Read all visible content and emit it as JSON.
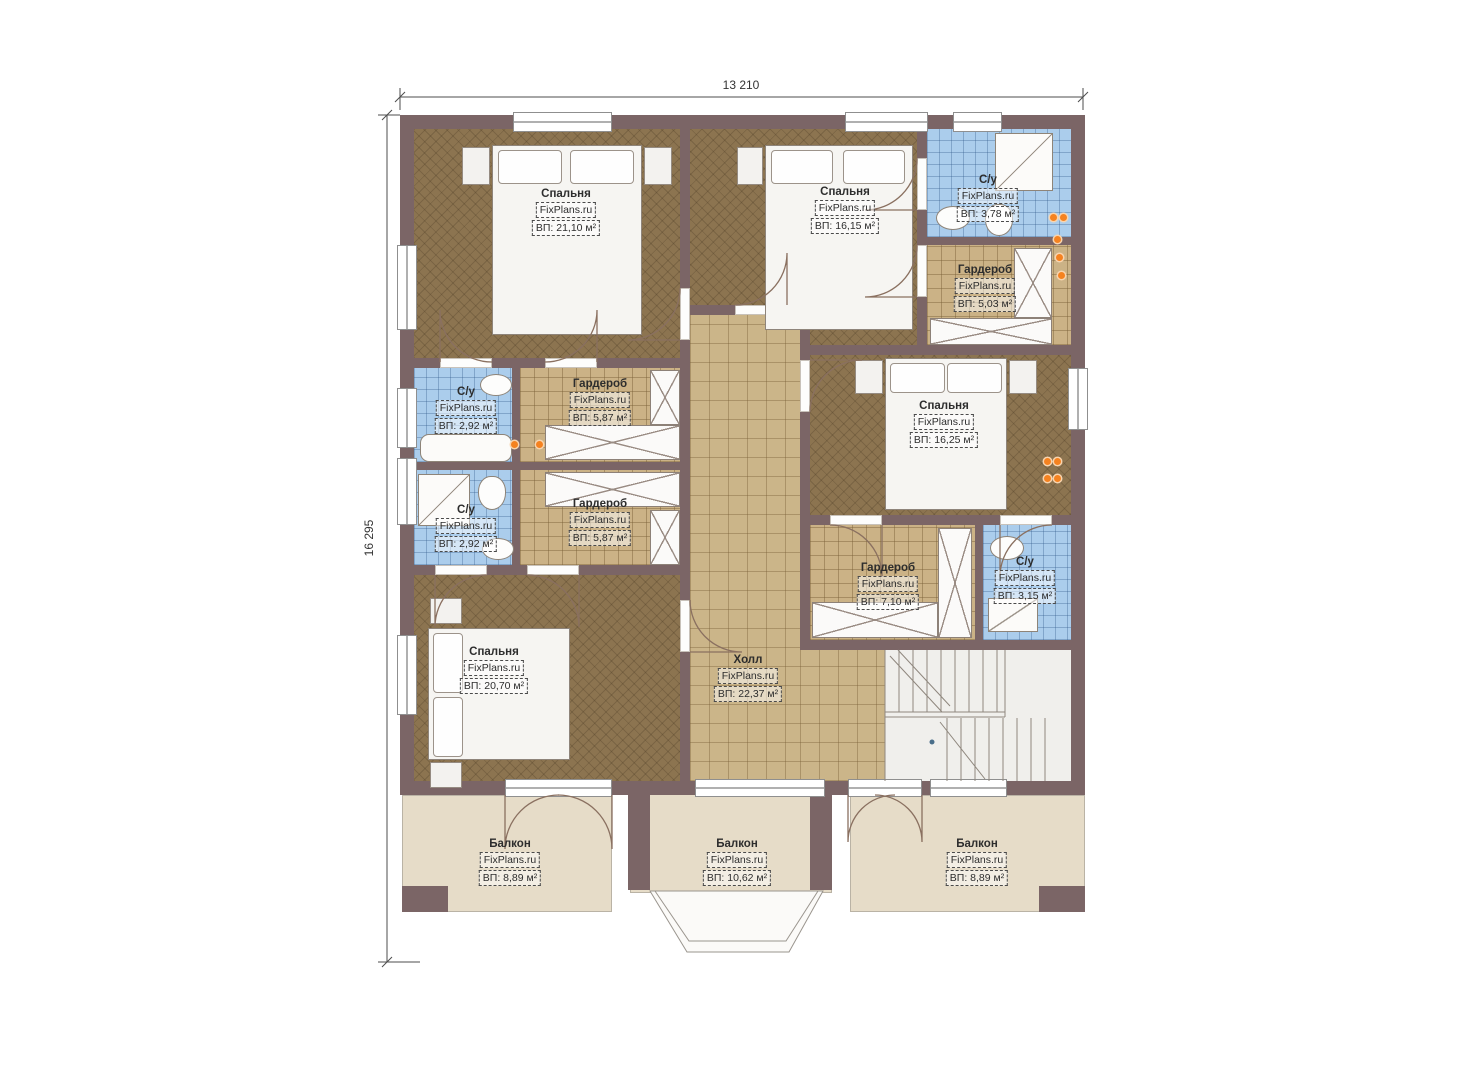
{
  "watermark": "FixPlans.ru",
  "dimensions": {
    "width_label": "13 210",
    "height_label": "16 295"
  },
  "colors": {
    "wall": "#7b6566",
    "bedroom_floor": "#8c7450",
    "tile_floor": "#cbb286",
    "bathroom_floor": "#abcdec",
    "balcony_floor": "#e6dcc8",
    "stairs_floor": "#f0efec",
    "outlet": "#f58220"
  },
  "rooms": [
    {
      "id": "bedroom-top-left",
      "name": "Спальня",
      "area": "ВП: 21,10 м²"
    },
    {
      "id": "bedroom-top-middle",
      "name": "Спальня",
      "area": "ВП: 16,15 м²"
    },
    {
      "id": "bathroom-top-right",
      "name": "С/у",
      "area": "ВП: 3,78 м²"
    },
    {
      "id": "wardrobe-top-right",
      "name": "Гардероб",
      "area": "ВП: 5,03 м²"
    },
    {
      "id": "bathroom-mid-upper",
      "name": "С/у",
      "area": "ВП: 2,92 м²"
    },
    {
      "id": "wardrobe-mid-upper",
      "name": "Гардероб",
      "area": "ВП: 5,87 м²"
    },
    {
      "id": "bathroom-mid-lower",
      "name": "С/у",
      "area": "ВП: 2,92 м²"
    },
    {
      "id": "wardrobe-mid-lower",
      "name": "Гардероб",
      "area": "ВП: 5,87 м²"
    },
    {
      "id": "bedroom-right",
      "name": "Спальня",
      "area": "ВП: 16,25 м²"
    },
    {
      "id": "wardrobe-right",
      "name": "Гардероб",
      "area": "ВП: 7,10 м²"
    },
    {
      "id": "bathroom-right",
      "name": "С/у",
      "area": "ВП: 3,15 м²"
    },
    {
      "id": "bedroom-bottom-left",
      "name": "Спальня",
      "area": "ВП: 20,70 м²"
    },
    {
      "id": "hall",
      "name": "Холл",
      "area": "ВП: 22,37 м²"
    },
    {
      "id": "balcony-left",
      "name": "Балкон",
      "area": "ВП: 8,89 м²"
    },
    {
      "id": "balcony-middle",
      "name": "Балкон",
      "area": "ВП: 10,62 м²"
    },
    {
      "id": "balcony-right",
      "name": "Балкон",
      "area": "ВП: 8,89 м²"
    }
  ]
}
